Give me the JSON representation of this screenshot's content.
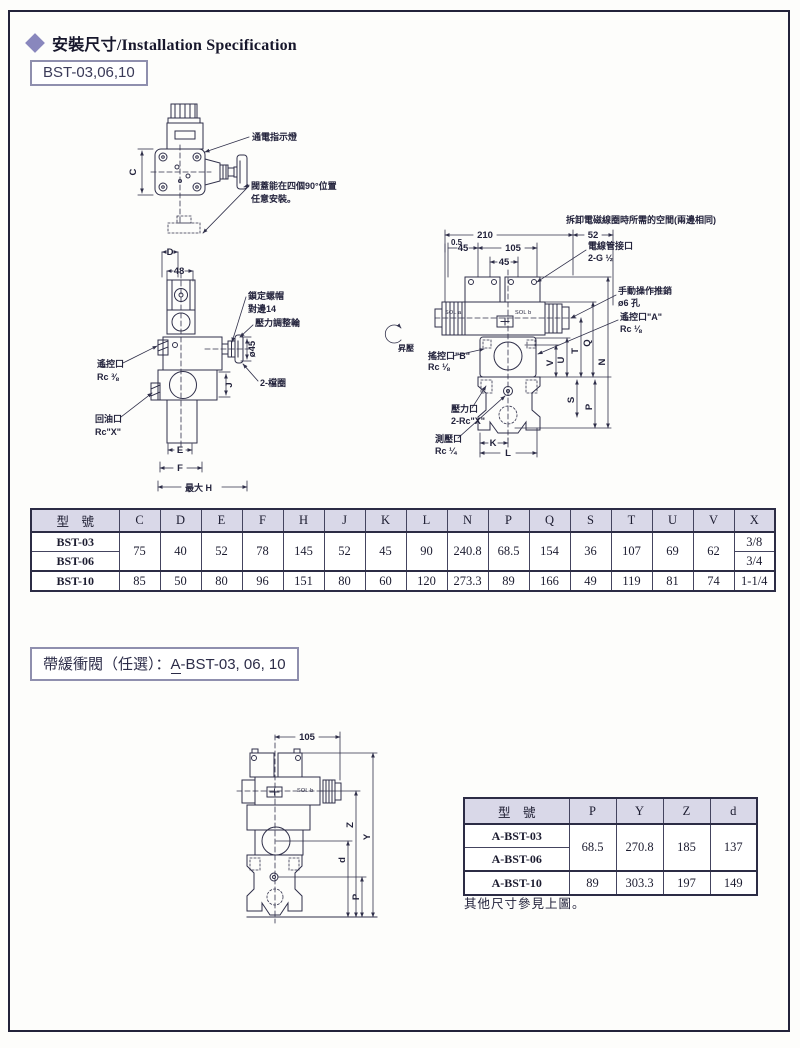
{
  "page": {
    "title_zh": "安裝尺寸",
    "title_sep": "/",
    "title_en": "Installation Specification",
    "model_box": "BST-03,06,10",
    "option_prefix": "帶緩衝閥（任選）：",
    "option_a": "A",
    "option_rest": "-BST-03, 06, 10",
    "note": "其他尺寸參見上圖。"
  },
  "colors": {
    "accent": "#8987bd",
    "line": "#30304a",
    "table_header_bg": "#d9d8e8"
  },
  "fig1": {
    "dim_c": "C",
    "indicator": "通電指示燈",
    "cover1": "閥蓋能在四個90°位置",
    "cover2": "任意安裝。"
  },
  "fig2": {
    "dim_d": "D",
    "dim_48": "48",
    "locknut1": "鎖定螺帽",
    "locknut2": "對邊14",
    "adjuster": "壓力調整輪",
    "dia45": "ø45",
    "rings": "2-檔圈",
    "remote1": "遙控口",
    "remote2": "Rc ⅜",
    "return1": "回油口",
    "return2": "Rc\"X\"",
    "dim_j": "J",
    "dim_e": "E",
    "dim_f": "F",
    "dim_maxh": "最大 H"
  },
  "fig3": {
    "space_note": "拆卸電磁線圈時所需的空間(兩邊相同)",
    "d210": "210",
    "d52": "52",
    "d05": "0.5",
    "d45a": "45",
    "d105": "105",
    "d45b": "45",
    "conduit1": "電線管接口",
    "conduit2": "2-G ½",
    "manual1": "手動操作推銷",
    "manual2": "ø6 孔",
    "porta1": "遙控口\"A\"",
    "porta2": "Rc ⅛",
    "portb1": "搖控口\"B\"",
    "portb2": "Rc ⅛",
    "rise": "昇壓",
    "pressure1": "壓力口",
    "pressure2": "2-Rc\"X\"",
    "gauge1": "測壓口",
    "gauge2": "Rc ¼",
    "sol_a": "SOL a",
    "sol_b": "SOL b",
    "dv": "V",
    "du": "U",
    "dt": "T",
    "dq": "Q",
    "dn": "N",
    "ds": "S",
    "dp": "P",
    "dk": "K",
    "dl": "L"
  },
  "fig4": {
    "d105": "105",
    "sol_b": "SOL b",
    "dz": "Z",
    "dy": "Y",
    "dd": "d",
    "dp": "P"
  },
  "table1": {
    "headers": [
      "型　號",
      "C",
      "D",
      "E",
      "F",
      "H",
      "J",
      "K",
      "L",
      "N",
      "P",
      "Q",
      "S",
      "T",
      "U",
      "V",
      "X"
    ],
    "group": {
      "models": [
        "BST-03",
        "BST-06"
      ],
      "values": [
        "75",
        "40",
        "52",
        "78",
        "145",
        "52",
        "45",
        "90",
        "240.8",
        "68.5",
        "154",
        "36",
        "107",
        "69",
        "62"
      ],
      "x": [
        "3/8",
        "3/4"
      ]
    },
    "last": {
      "model": "BST-10",
      "values": [
        "85",
        "50",
        "80",
        "96",
        "151",
        "80",
        "60",
        "120",
        "273.3",
        "89",
        "166",
        "49",
        "119",
        "81",
        "74"
      ],
      "x": "1-1/4"
    }
  },
  "table2": {
    "headers": [
      "型　號",
      "P",
      "Y",
      "Z",
      "d"
    ],
    "group": {
      "models": [
        "A-BST-03",
        "A-BST-06"
      ],
      "values": [
        "68.5",
        "270.8",
        "185",
        "137"
      ]
    },
    "last": {
      "model": "A-BST-10",
      "values": [
        "89",
        "303.3",
        "197",
        "149"
      ]
    }
  }
}
